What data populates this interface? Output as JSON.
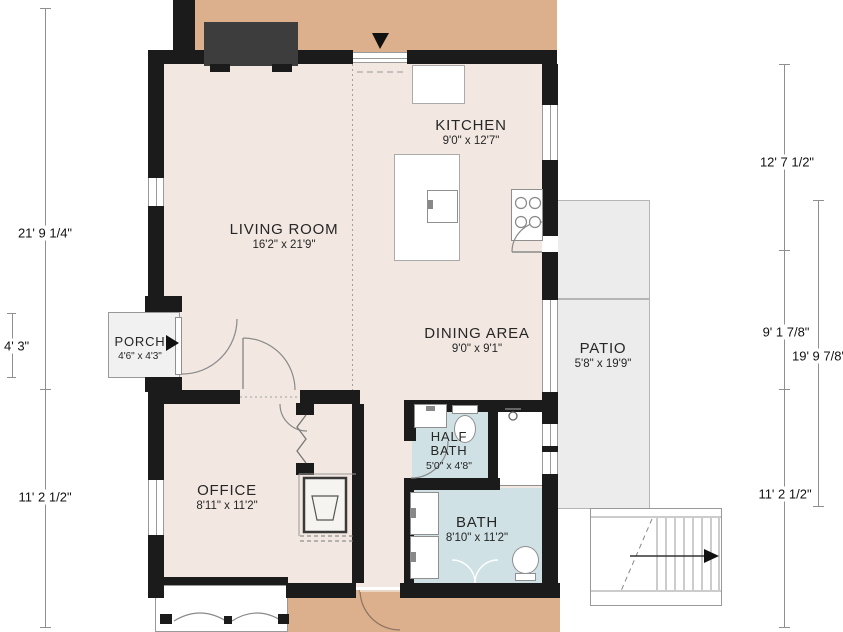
{
  "rooms": [
    {
      "name": "KITCHEN",
      "dims": "9'0\" x 12'7\""
    },
    {
      "name": "LIVING ROOM",
      "dims": "16'2\" x 21'9\""
    },
    {
      "name": "DINING AREA",
      "dims": "9'0\" x 9'1\""
    },
    {
      "name": "PORCH",
      "dims": "4'6\" x 4'3\""
    },
    {
      "name": "PATIO",
      "dims": "5'8\" x 19'9\""
    },
    {
      "name": "OFFICE",
      "dims": "8'11\" x 11'2\""
    },
    {
      "name": "HALF BATH",
      "dims": "5'0\" x 4'8\""
    },
    {
      "name": "BATH",
      "dims": "8'10\" x 11'2\""
    }
  ],
  "dimensions": {
    "left_total": "21' 9 1/4\"",
    "porch_height": "4' 3\"",
    "left_lower": "11' 2 1/2\"",
    "right_kitchen": "12' 7 1/2\"",
    "right_dining": "9' 1 7/8\"",
    "right_patio": "19' 9 7/8\"",
    "right_lower": "11' 2 1/2\""
  },
  "colors": {
    "wall": "#1b1b1b",
    "deck_tan": "#ddb08d",
    "interior_cream": "#f2e8e1",
    "bath_blue": "#cfe1e4",
    "patio_gray": "#ececec",
    "fireplace_gray": "#3d3d3d"
  }
}
